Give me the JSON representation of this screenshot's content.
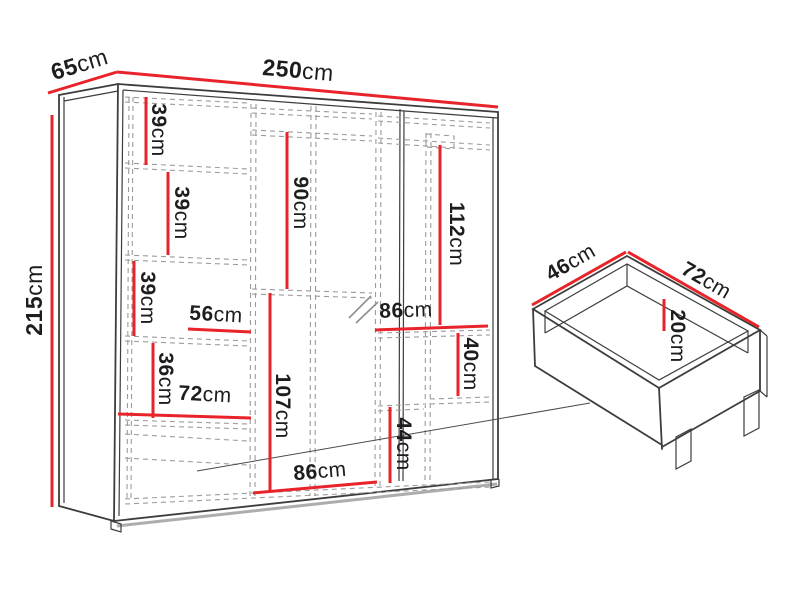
{
  "diagram_type": "furniture-dimension-diagram",
  "colors": {
    "dimension_line": "#e8232a",
    "outline": "#3d3d3b",
    "dashed_line": "#9b9b9b",
    "label_text": "#1d1d1b",
    "background": "#ffffff"
  },
  "wardrobe": {
    "overall_dimensions": [
      {
        "id": "depth",
        "value": "65",
        "unit": "cm"
      },
      {
        "id": "width",
        "value": "250",
        "unit": "cm"
      },
      {
        "id": "height",
        "value": "215",
        "unit": "cm"
      }
    ],
    "internal_dimensions": [
      {
        "id": "left-shelf-1",
        "value": "39",
        "unit": "cm"
      },
      {
        "id": "left-shelf-2",
        "value": "39",
        "unit": "cm"
      },
      {
        "id": "left-shelf-3",
        "value": "39",
        "unit": "cm"
      },
      {
        "id": "left-width-56",
        "value": "56",
        "unit": "cm"
      },
      {
        "id": "left-shelf-36",
        "value": "36",
        "unit": "cm"
      },
      {
        "id": "left-width-72",
        "value": "72",
        "unit": "cm"
      },
      {
        "id": "middle-height-90",
        "value": "90",
        "unit": "cm"
      },
      {
        "id": "middle-height-107",
        "value": "107",
        "unit": "cm"
      },
      {
        "id": "middle-width-86",
        "value": "86",
        "unit": "cm"
      },
      {
        "id": "right-height-112",
        "value": "112",
        "unit": "cm"
      },
      {
        "id": "right-width-86",
        "value": "86",
        "unit": "cm"
      },
      {
        "id": "right-height-40",
        "value": "40",
        "unit": "cm"
      },
      {
        "id": "right-height-44",
        "value": "44",
        "unit": "cm"
      }
    ]
  },
  "drawer": {
    "dimensions": [
      {
        "id": "drawer-depth-46",
        "value": "46",
        "unit": "cm"
      },
      {
        "id": "drawer-width-72",
        "value": "72",
        "unit": "cm"
      },
      {
        "id": "drawer-height-20",
        "value": "20",
        "unit": "cm"
      }
    ]
  }
}
